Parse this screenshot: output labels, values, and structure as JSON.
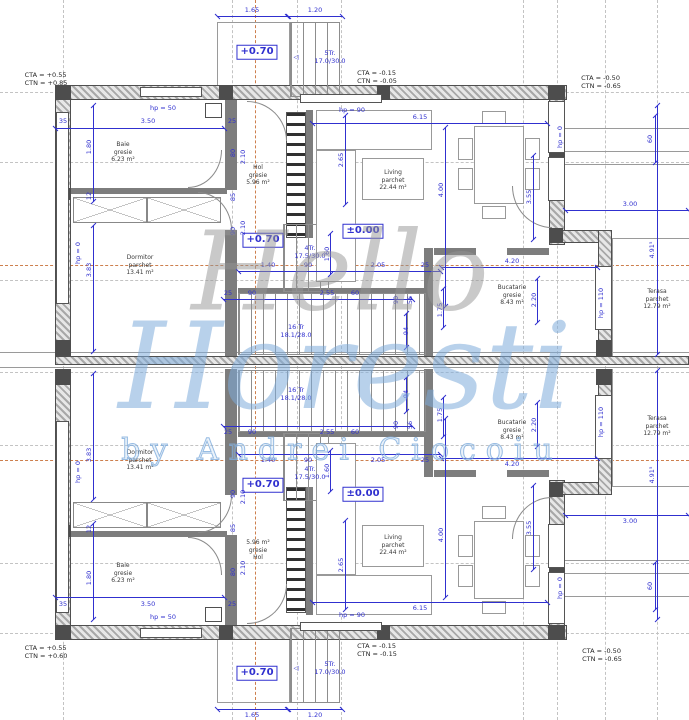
{
  "watermark": [
    {
      "t": "Hello",
      "x": 340,
      "y": 272,
      "c": "wm1"
    },
    {
      "t": "Horesti",
      "x": 345,
      "y": 368,
      "c": "wm2"
    },
    {
      "t": "by Andrei Ciocoiu",
      "x": 342,
      "y": 450,
      "c": "wm3"
    }
  ],
  "corner_labels": [
    {
      "t": "CTA = +0.55\nCTN = +0.85",
      "x": 46,
      "y": 79
    },
    {
      "t": "CTA = -0.15\nCTN = -0.05",
      "x": 377,
      "y": 77
    },
    {
      "t": "CTA = -0.50\nCTN = -0.65",
      "x": 601,
      "y": 82
    },
    {
      "t": "CTA = +0.55\nCTN = +0.60",
      "x": 46,
      "y": 652
    },
    {
      "t": "CTA = -0.15\nCTN = -0.15",
      "x": 377,
      "y": 650
    },
    {
      "t": "CTA = -0.50\nCTN = -0.65",
      "x": 602,
      "y": 655
    }
  ],
  "rooms": [
    {
      "t": "Baie\ngresie\n6.23 m²",
      "x": 123,
      "y": 152
    },
    {
      "t": "Dormitor\nparchet\n13.41 m²",
      "x": 140,
      "y": 265
    },
    {
      "t": "Hol\ngresie\n5.96 m²",
      "x": 258,
      "y": 175
    },
    {
      "t": "Living\nparchet\n22.44 m²",
      "x": 393,
      "y": 180
    },
    {
      "t": "Bucatarie\ngresie\n8.43 m²",
      "x": 512,
      "y": 295
    },
    {
      "t": "Terasa\nparchet\n12.79 m²",
      "x": 657,
      "y": 299
    },
    {
      "t": "Baie\ngresie\n6.23 m²",
      "x": 123,
      "y": 573
    },
    {
      "t": "Dormitor\nparchet\n13.41 m²",
      "x": 140,
      "y": 460
    },
    {
      "t": "5.96 m²\ngresie\nHol",
      "x": 258,
      "y": 550
    },
    {
      "t": "Living\nparchet\n22.44 m²",
      "x": 393,
      "y": 545
    },
    {
      "t": "Bucatarie\ngresie\n8.43 m²",
      "x": 512,
      "y": 430
    },
    {
      "t": "Terasa\nparchet\n12.79 m²",
      "x": 657,
      "y": 426
    }
  ],
  "elevations": [
    {
      "t": "+0.70",
      "x": 257,
      "y": 52
    },
    {
      "t": "+0.70",
      "x": 263,
      "y": 240
    },
    {
      "t": "±0.00",
      "x": 363,
      "y": 231
    }
  ],
  "stair_labels": [
    {
      "t": "5Tr.\n17.0/30.0",
      "x": 330,
      "y": 57
    },
    {
      "t": "◁",
      "x": 296,
      "y": 57
    },
    {
      "t": "4Tr.\n17.5/30.0",
      "x": 310,
      "y": 252
    },
    {
      "t": "16 Tr\n18.1/28.0",
      "x": 296,
      "y": 331
    }
  ],
  "dim_labels": [
    {
      "t": "1.65",
      "x": 252,
      "y": 10
    },
    {
      "t": "1.20",
      "x": 315,
      "y": 10
    },
    {
      "t": "35",
      "x": 63,
      "y": 121
    },
    {
      "t": "3.50",
      "x": 148,
      "y": 121
    },
    {
      "t": "25",
      "x": 232,
      "y": 121
    },
    {
      "t": "6.15",
      "x": 420,
      "y": 117
    },
    {
      "t": "hp = 50",
      "x": 163,
      "y": 108
    },
    {
      "t": "hp = 90",
      "x": 352,
      "y": 110
    },
    {
      "t": "1.40",
      "x": 268,
      "y": 265
    },
    {
      "t": "90",
      "x": 308,
      "y": 265
    },
    {
      "t": "2.05",
      "x": 378,
      "y": 265
    },
    {
      "t": "25",
      "x": 425,
      "y": 265
    },
    {
      "t": "4.20",
      "x": 512,
      "y": 261
    },
    {
      "t": "3.00",
      "x": 630,
      "y": 204
    },
    {
      "t": "25",
      "x": 228,
      "y": 293
    },
    {
      "t": "90",
      "x": 252,
      "y": 293
    },
    {
      "t": "2.55",
      "x": 327,
      "y": 293
    },
    {
      "t": "60",
      "x": 355,
      "y": 293
    },
    {
      "t": "90",
      "x": 396,
      "y": 300,
      "r": -90
    },
    {
      "t": "56",
      "x": 410,
      "y": 300,
      "r": -90
    },
    {
      "t": "94",
      "x": 406,
      "y": 331,
      "r": -90
    },
    {
      "t": "1.75",
      "x": 440,
      "y": 310,
      "r": -90
    },
    {
      "t": "2.20",
      "x": 534,
      "y": 300,
      "r": -90
    },
    {
      "t": "2.65",
      "x": 341,
      "y": 160,
      "r": -90
    },
    {
      "t": "4.00",
      "x": 441,
      "y": 190,
      "r": -90
    },
    {
      "t": "1.60",
      "x": 327,
      "y": 254,
      "r": -90
    },
    {
      "t": "3.55",
      "x": 529,
      "y": 197,
      "r": -90
    },
    {
      "t": "1.80",
      "x": 89,
      "y": 147,
      "r": -90
    },
    {
      "t": "12",
      "x": 89,
      "y": 196,
      "r": -90
    },
    {
      "t": "3.83",
      "x": 89,
      "y": 270,
      "r": -90
    },
    {
      "t": "hp = 0",
      "x": 78,
      "y": 253,
      "r": -90
    },
    {
      "t": "hp = 0",
      "x": 560,
      "y": 137,
      "r": -90
    },
    {
      "t": "hp = 110",
      "x": 601,
      "y": 303,
      "r": -90
    },
    {
      "t": "60",
      "x": 650,
      "y": 139,
      "r": -90
    },
    {
      "t": "4.91⁵",
      "x": 652,
      "y": 250,
      "r": -90
    },
    {
      "t": "80",
      "x": 233,
      "y": 153,
      "r": -90
    },
    {
      "t": "2.10",
      "x": 243,
      "y": 157,
      "r": -90
    },
    {
      "t": "85",
      "x": 233,
      "y": 197,
      "r": -90
    },
    {
      "t": "90",
      "x": 233,
      "y": 231,
      "r": -90
    },
    {
      "t": "2.10",
      "x": 243,
      "y": 228,
      "r": -90
    }
  ],
  "dim_lines_h": [
    {
      "x": 217,
      "y": 16,
      "w": 71
    },
    {
      "x": 288,
      "y": 16,
      "w": 55
    },
    {
      "x": 55,
      "y": 128,
      "w": 170
    },
    {
      "x": 312,
      "y": 123,
      "w": 236
    },
    {
      "x": 238,
      "y": 271,
      "w": 203
    },
    {
      "x": 441,
      "y": 267,
      "w": 157
    },
    {
      "x": 565,
      "y": 210,
      "w": 124
    },
    {
      "x": 223,
      "y": 299,
      "w": 190
    }
  ],
  "dim_lines_v": [
    {
      "x": 93,
      "y": 105,
      "h": 97
    },
    {
      "x": 93,
      "y": 225,
      "h": 127
    },
    {
      "x": 345,
      "y": 115,
      "h": 90
    },
    {
      "x": 445,
      "y": 127,
      "h": 180
    },
    {
      "x": 330,
      "y": 233,
      "h": 42
    },
    {
      "x": 533,
      "y": 155,
      "h": 85
    },
    {
      "x": 537,
      "y": 278,
      "h": 45
    },
    {
      "x": 443,
      "y": 288,
      "h": 40
    },
    {
      "x": 655,
      "y": 115,
      "h": 48
    },
    {
      "x": 657,
      "y": 105,
      "h": 250
    },
    {
      "x": 406,
      "y": 313,
      "h": 35
    }
  ],
  "rects": [
    {
      "c": "wh",
      "x": 55,
      "y": 85,
      "w": 512,
      "h": 15
    },
    {
      "c": "wh",
      "x": 55,
      "y": 85,
      "w": 16,
      "h": 271
    },
    {
      "c": "wh",
      "x": 549,
      "y": 85,
      "w": 16,
      "h": 160
    },
    {
      "c": "wh",
      "x": 549,
      "y": 230,
      "w": 63,
      "h": 13
    },
    {
      "c": "wh",
      "x": 598,
      "y": 230,
      "w": 14,
      "h": 126
    },
    {
      "c": "wh",
      "x": 55,
      "y": 356,
      "w": 634,
      "h": 9,
      "m": 0
    },
    {
      "c": "ln",
      "x": 0,
      "y": 352,
      "w": 689,
      "h": 1,
      "m": 0
    },
    {
      "c": "ln",
      "x": 0,
      "y": 367,
      "w": 689,
      "h": 1,
      "m": 0
    },
    {
      "c": "pier",
      "x": 55,
      "y": 85,
      "w": 16,
      "h": 15
    },
    {
      "c": "pier",
      "x": 219,
      "y": 85,
      "w": 14,
      "h": 15
    },
    {
      "c": "pier",
      "x": 377,
      "y": 85,
      "w": 13,
      "h": 15
    },
    {
      "c": "pier",
      "x": 548,
      "y": 85,
      "w": 17,
      "h": 15
    },
    {
      "c": "pier",
      "x": 55,
      "y": 188,
      "w": 16,
      "h": 12
    },
    {
      "c": "pier",
      "x": 55,
      "y": 340,
      "w": 16,
      "h": 15
    },
    {
      "c": "pier",
      "x": 549,
      "y": 148,
      "w": 16,
      "h": 10
    },
    {
      "c": "pier",
      "x": 549,
      "y": 228,
      "w": 14,
      "h": 15
    },
    {
      "c": "pier",
      "x": 596,
      "y": 340,
      "w": 16,
      "h": 16
    },
    {
      "c": "iw",
      "x": 225,
      "y": 100,
      "w": 12,
      "h": 90
    },
    {
      "c": "iw",
      "x": 225,
      "y": 230,
      "w": 12,
      "h": 126
    },
    {
      "c": "iw",
      "x": 71,
      "y": 188,
      "w": 156,
      "h": 6
    },
    {
      "c": "iw",
      "x": 306,
      "y": 110,
      "w": 7,
      "h": 128
    },
    {
      "c": "iw",
      "x": 424,
      "y": 248,
      "w": 9,
      "h": 108
    },
    {
      "c": "iw",
      "x": 434,
      "y": 248,
      "w": 42,
      "h": 7
    },
    {
      "c": "iw",
      "x": 507,
      "y": 248,
      "w": 42,
      "h": 7
    },
    {
      "c": "iw",
      "x": 238,
      "y": 288,
      "w": 190,
      "h": 5
    },
    {
      "c": "win",
      "x": 140,
      "y": 87,
      "w": 62,
      "h": 10
    },
    {
      "c": "win",
      "x": 300,
      "y": 94,
      "w": 82,
      "h": 9
    },
    {
      "c": "win",
      "x": 56,
      "y": 112,
      "w": 13,
      "h": 192
    },
    {
      "c": "win",
      "x": 548,
      "y": 101,
      "w": 17,
      "h": 52
    },
    {
      "c": "win",
      "x": 548,
      "y": 157,
      "w": 17,
      "h": 44
    },
    {
      "c": "win",
      "x": 595,
      "y": 266,
      "w": 17,
      "h": 64
    },
    {
      "c": "porch",
      "x": 217,
      "y": 22,
      "w": 73,
      "h": 75
    },
    {
      "c": "tread",
      "x": 290,
      "y": 22,
      "w": 50,
      "h": 75
    },
    {
      "c": "duct",
      "x": 205,
      "y": 103,
      "w": 17,
      "h": 15
    },
    {
      "c": "ln",
      "x": 565,
      "y": 128,
      "w": 124,
      "h": 1
    },
    {
      "c": "ln",
      "x": 565,
      "y": 151,
      "w": 124,
      "h": 1
    },
    {
      "c": "ln",
      "x": 565,
      "y": 164,
      "w": 124,
      "h": 1
    },
    {
      "c": "ln",
      "x": 612,
      "y": 238,
      "w": 77,
      "h": 1
    },
    {
      "c": "ln",
      "x": 612,
      "y": 238,
      "w": 1,
      "h": 118
    },
    {
      "c": "sect",
      "x": 286,
      "y": 112,
      "w": 20,
      "h": 126
    },
    {
      "c": "tread",
      "x": 283,
      "y": 224,
      "w": 46,
      "h": 68
    },
    {
      "c": "tread",
      "x": 238,
      "y": 293,
      "w": 188,
      "h": 62
    },
    {
      "c": "furn",
      "x": 316,
      "y": 110,
      "w": 116,
      "h": 40
    },
    {
      "c": "furn",
      "x": 316,
      "y": 150,
      "w": 40,
      "h": 132
    },
    {
      "c": "furn",
      "x": 362,
      "y": 158,
      "w": 62,
      "h": 42
    },
    {
      "c": "furn",
      "x": 474,
      "y": 126,
      "w": 50,
      "h": 78
    },
    {
      "c": "furn",
      "x": 482,
      "y": 111,
      "w": 24,
      "h": 13
    },
    {
      "c": "furn",
      "x": 482,
      "y": 206,
      "w": 24,
      "h": 13
    },
    {
      "c": "furn",
      "x": 458,
      "y": 138,
      "w": 15,
      "h": 22
    },
    {
      "c": "furn",
      "x": 458,
      "y": 168,
      "w": 15,
      "h": 22
    },
    {
      "c": "furn",
      "x": 525,
      "y": 138,
      "w": 15,
      "h": 22
    },
    {
      "c": "furn",
      "x": 525,
      "y": 168,
      "w": 15,
      "h": 22
    },
    {
      "c": "xbox",
      "x": 73,
      "y": 197,
      "w": 74,
      "h": 26
    },
    {
      "c": "xbox",
      "x": 147,
      "y": 197,
      "w": 74,
      "h": 26
    },
    {
      "c": "arcTR",
      "x": 247,
      "y": 101,
      "w": 40,
      "h": 40
    },
    {
      "c": "arcBR",
      "x": 188,
      "y": 150,
      "w": 34,
      "h": 38
    },
    {
      "c": "arcTR",
      "x": 198,
      "y": 192,
      "w": 34,
      "h": 38
    },
    {
      "c": "arcBL",
      "x": 512,
      "y": 186,
      "w": 40,
      "h": 42
    }
  ],
  "grid": {
    "v": [
      63,
      232,
      297,
      341,
      523,
      557,
      605,
      657
    ],
    "h": [
      92,
      162,
      280,
      352,
      372,
      445,
      563,
      633
    ],
    "ov": [
      255
    ],
    "oh": [
      265,
      460
    ]
  }
}
